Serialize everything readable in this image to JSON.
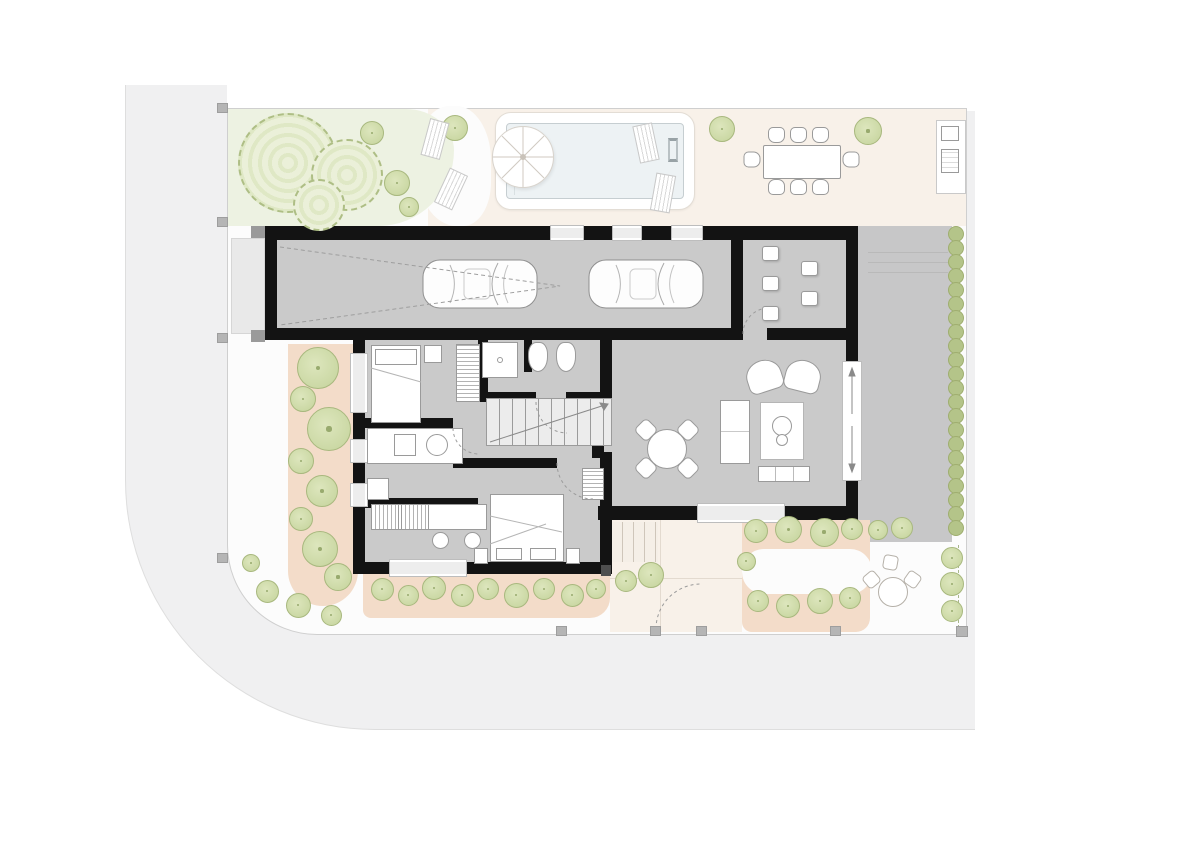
{
  "palette": {
    "page": "#ffffff",
    "road": "#f0f0f1",
    "curb": "#dedede",
    "plot": "#fcfcfc",
    "fence": "#cfcfcf",
    "grass": "#edf2e2",
    "terrace": "#f8f1e9",
    "salmon": "#f3dcc9",
    "floor": "#cacaca",
    "driveway": "#c7c7c8",
    "wall": "#131313",
    "window": "#ededed",
    "water": "#edf2f4",
    "tree_fill": "#cdd9a5",
    "tree_stroke": "#a8b87e",
    "hedge": "#b4c489",
    "furniture_stroke": "#9a9a9a",
    "apron": "#e9e9e9"
  },
  "areas": [
    "garden-lawn",
    "pool-terrace",
    "swimming-pool",
    "outdoor-dining",
    "outdoor-kitchen",
    "garage",
    "mudroom",
    "hallway",
    "bathroom",
    "bedroom",
    "kitchen",
    "study",
    "master-bedroom",
    "living-room",
    "entry-path",
    "driveway",
    "planting-beds",
    "road"
  ],
  "hedge_row": {
    "x": 956,
    "y_start": 234,
    "y_end": 540,
    "step": 14,
    "d": 16
  },
  "sprites": [
    {
      "t": "bigtree",
      "x": 288,
      "y": 163,
      "d": 100
    },
    {
      "t": "bigtree",
      "x": 347,
      "y": 175,
      "d": 72
    },
    {
      "t": "bigtree",
      "x": 319,
      "y": 205,
      "d": 52
    },
    {
      "t": "tree",
      "x": 372,
      "y": 133,
      "d": 24
    },
    {
      "t": "tree",
      "x": 455,
      "y": 128,
      "d": 26
    },
    {
      "t": "tree",
      "x": 397,
      "y": 183,
      "d": 26
    },
    {
      "t": "tree",
      "x": 409,
      "y": 207,
      "d": 20
    },
    {
      "t": "tree",
      "x": 722,
      "y": 129,
      "d": 26
    },
    {
      "t": "tree",
      "x": 868,
      "y": 131,
      "d": 28
    },
    {
      "t": "tree",
      "x": 318,
      "y": 368,
      "d": 42
    },
    {
      "t": "tree",
      "x": 303,
      "y": 399,
      "d": 26
    },
    {
      "t": "tree",
      "x": 329,
      "y": 429,
      "d": 44
    },
    {
      "t": "tree",
      "x": 301,
      "y": 461,
      "d": 26
    },
    {
      "t": "tree",
      "x": 322,
      "y": 491,
      "d": 32
    },
    {
      "t": "tree",
      "x": 301,
      "y": 519,
      "d": 24
    },
    {
      "t": "tree",
      "x": 320,
      "y": 549,
      "d": 36
    },
    {
      "t": "tree",
      "x": 338,
      "y": 577,
      "d": 28
    },
    {
      "t": "tree",
      "x": 251,
      "y": 563,
      "d": 18
    },
    {
      "t": "tree",
      "x": 267,
      "y": 591,
      "d": 23
    },
    {
      "t": "tree",
      "x": 298,
      "y": 605,
      "d": 25
    },
    {
      "t": "tree",
      "x": 331,
      "y": 615,
      "d": 21
    },
    {
      "t": "tree",
      "x": 382,
      "y": 589,
      "d": 23
    },
    {
      "t": "tree",
      "x": 408,
      "y": 595,
      "d": 21
    },
    {
      "t": "tree",
      "x": 434,
      "y": 588,
      "d": 24
    },
    {
      "t": "tree",
      "x": 462,
      "y": 595,
      "d": 23
    },
    {
      "t": "tree",
      "x": 488,
      "y": 589,
      "d": 22
    },
    {
      "t": "tree",
      "x": 516,
      "y": 595,
      "d": 25
    },
    {
      "t": "tree",
      "x": 544,
      "y": 589,
      "d": 22
    },
    {
      "t": "tree",
      "x": 572,
      "y": 595,
      "d": 23
    },
    {
      "t": "tree",
      "x": 596,
      "y": 589,
      "d": 20
    },
    {
      "t": "tree",
      "x": 626,
      "y": 581,
      "d": 22
    },
    {
      "t": "tree",
      "x": 651,
      "y": 575,
      "d": 26
    },
    {
      "t": "tree",
      "x": 756,
      "y": 531,
      "d": 24
    },
    {
      "t": "tree",
      "x": 788,
      "y": 529,
      "d": 27
    },
    {
      "t": "tree",
      "x": 824,
      "y": 532,
      "d": 29
    },
    {
      "t": "tree",
      "x": 852,
      "y": 529,
      "d": 22
    },
    {
      "t": "tree",
      "x": 746,
      "y": 561,
      "d": 19
    },
    {
      "t": "tree",
      "x": 758,
      "y": 601,
      "d": 22
    },
    {
      "t": "tree",
      "x": 788,
      "y": 606,
      "d": 24
    },
    {
      "t": "tree",
      "x": 820,
      "y": 601,
      "d": 26
    },
    {
      "t": "tree",
      "x": 850,
      "y": 598,
      "d": 22
    },
    {
      "t": "tree",
      "x": 878,
      "y": 530,
      "d": 20
    },
    {
      "t": "tree",
      "x": 902,
      "y": 528,
      "d": 22
    },
    {
      "t": "tree",
      "x": 952,
      "y": 558,
      "d": 22
    },
    {
      "t": "tree",
      "x": 952,
      "y": 584,
      "d": 24
    },
    {
      "t": "tree",
      "x": 952,
      "y": 611,
      "d": 22
    },
    {
      "t": "post",
      "x": 217,
      "y": 103,
      "w": 11,
      "h": 10
    },
    {
      "t": "post",
      "x": 217,
      "y": 217,
      "w": 11,
      "h": 10
    },
    {
      "t": "post",
      "x": 217,
      "y": 333,
      "w": 11,
      "h": 10
    },
    {
      "t": "post",
      "x": 217,
      "y": 553,
      "w": 11,
      "h": 10
    },
    {
      "t": "post",
      "x": 556,
      "y": 626,
      "w": 11,
      "h": 10
    },
    {
      "t": "post",
      "x": 650,
      "y": 626,
      "w": 11,
      "h": 10
    },
    {
      "t": "post",
      "x": 696,
      "y": 626,
      "w": 11,
      "h": 10
    },
    {
      "t": "post",
      "x": 830,
      "y": 626,
      "w": 11,
      "h": 10
    },
    {
      "t": "post",
      "x": 956,
      "y": 626,
      "w": 12,
      "h": 11
    },
    {
      "t": "seat",
      "x": 762,
      "y": 246,
      "w": 17,
      "h": 15
    },
    {
      "t": "seat",
      "x": 762,
      "y": 276,
      "w": 17,
      "h": 15
    },
    {
      "t": "seat",
      "x": 762,
      "y": 306,
      "w": 17,
      "h": 15
    },
    {
      "t": "seat",
      "x": 801,
      "y": 261,
      "w": 17,
      "h": 15
    },
    {
      "t": "seat",
      "x": 801,
      "y": 291,
      "w": 17,
      "h": 15
    },
    {
      "t": "chair",
      "x": 768,
      "y": 127,
      "w": 17,
      "h": 16
    },
    {
      "t": "chair",
      "x": 790,
      "y": 127,
      "w": 17,
      "h": 16
    },
    {
      "t": "chair",
      "x": 812,
      "y": 127,
      "w": 17,
      "h": 16
    },
    {
      "t": "chair",
      "x": 768,
      "y": 179,
      "w": 17,
      "h": 16,
      "r": 180
    },
    {
      "t": "chair",
      "x": 790,
      "y": 179,
      "w": 17,
      "h": 16,
      "r": 180
    },
    {
      "t": "chair",
      "x": 812,
      "y": 179,
      "w": 17,
      "h": 16,
      "r": 180
    },
    {
      "t": "chair",
      "x": 744,
      "y": 151,
      "w": 16,
      "h": 17,
      "r": -90
    },
    {
      "t": "chair",
      "x": 843,
      "y": 151,
      "w": 16,
      "h": 17,
      "r": 90
    },
    {
      "t": "chair4",
      "x": 637,
      "y": 421,
      "w": 18,
      "h": 18,
      "r": 45
    },
    {
      "t": "chair4",
      "x": 679,
      "y": 421,
      "w": 18,
      "h": 18,
      "r": 135
    },
    {
      "t": "chair4",
      "x": 637,
      "y": 459,
      "w": 18,
      "h": 18,
      "r": -45
    },
    {
      "t": "chair4",
      "x": 679,
      "y": 459,
      "w": 18,
      "h": 18,
      "r": -135
    },
    {
      "t": "lounger",
      "x": 425,
      "y": 120,
      "w": 20,
      "h": 38,
      "r": 15
    },
    {
      "t": "lounger",
      "x": 441,
      "y": 170,
      "w": 20,
      "h": 38,
      "r": 25
    },
    {
      "t": "lounger",
      "x": 636,
      "y": 124,
      "w": 20,
      "h": 38,
      "r": -12
    },
    {
      "t": "lounger",
      "x": 653,
      "y": 174,
      "w": 20,
      "h": 38,
      "r": 10
    },
    {
      "t": "stool",
      "x": 432,
      "y": 532,
      "w": 17,
      "h": 17
    },
    {
      "t": "stool",
      "x": 464,
      "y": 532,
      "w": 17,
      "h": 17
    },
    {
      "t": "gchair",
      "x": 864,
      "y": 572,
      "w": 15,
      "h": 15,
      "r": -40
    },
    {
      "t": "gchair",
      "x": 883,
      "y": 555,
      "w": 15,
      "h": 15,
      "r": 10
    },
    {
      "t": "gchair",
      "x": 905,
      "y": 572,
      "w": 15,
      "h": 15,
      "r": 35
    }
  ]
}
